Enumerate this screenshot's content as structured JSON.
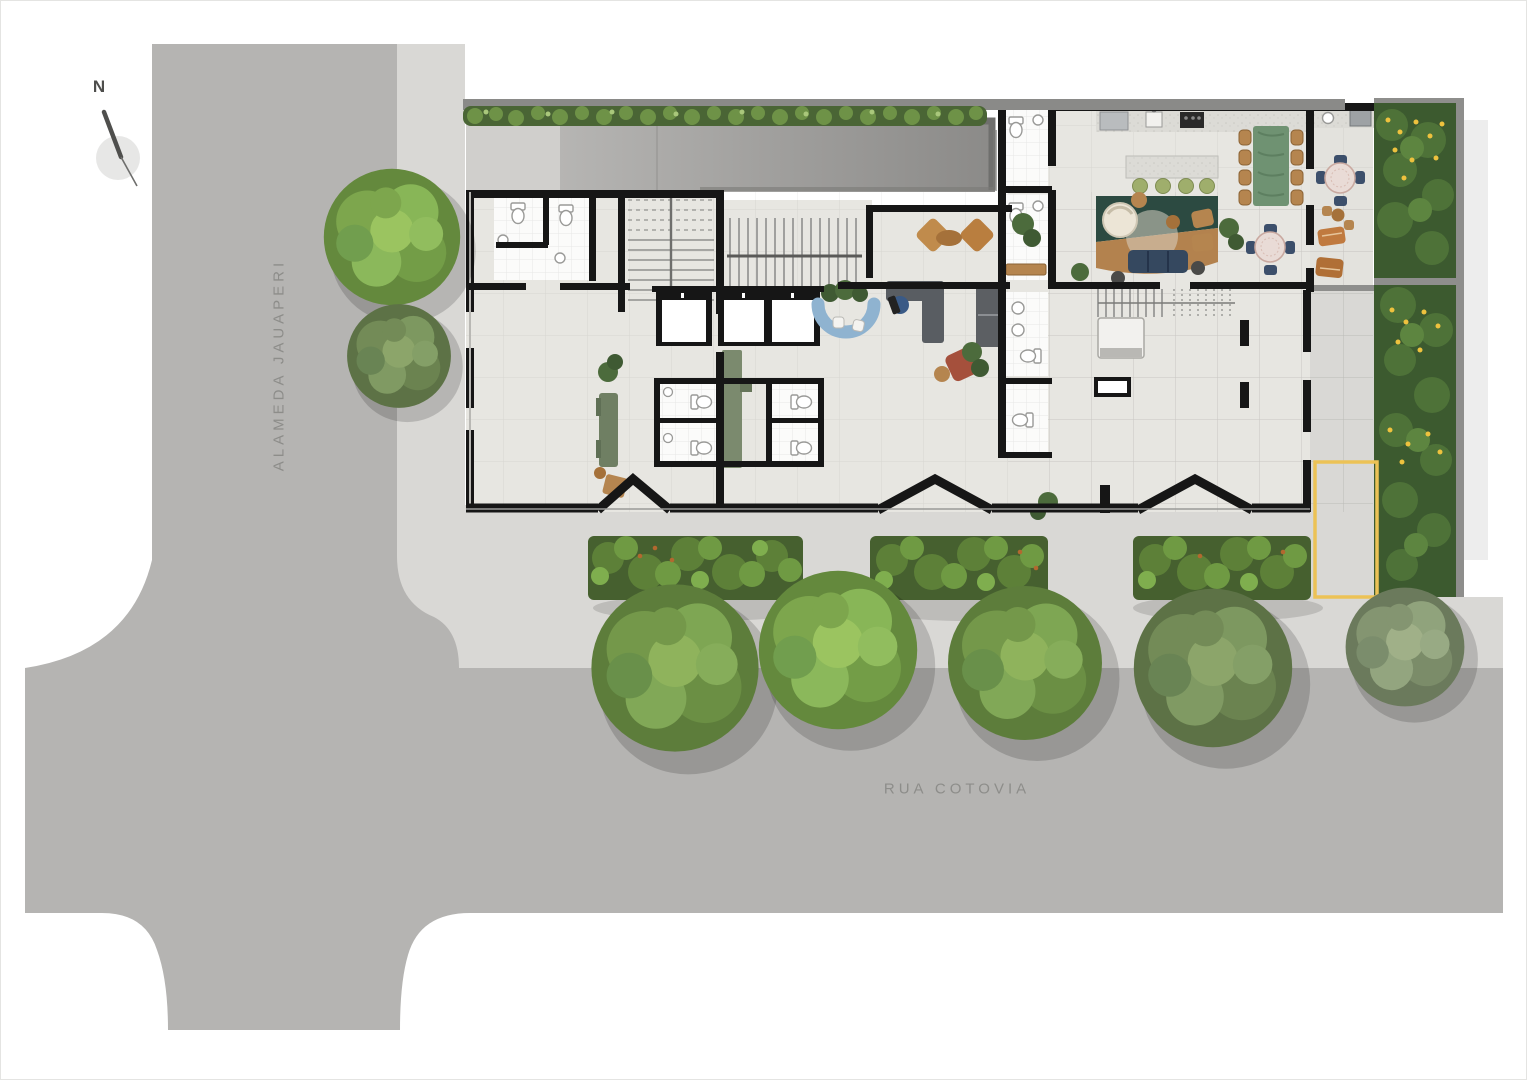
{
  "compass": {
    "label": "N"
  },
  "streets": [
    {
      "name": "ALAMEDA JAUAPERI",
      "orientation": "vertical"
    },
    {
      "name": "RUA COTOVIA",
      "orientation": "horizontal"
    }
  ],
  "palette": {
    "street": "#b5b4b2",
    "sidewalk": "#d9d8d5",
    "building_floor": "#e7e6e1",
    "bathroom_tile": "#fbfbfa",
    "wall": "#161616",
    "ramp_dark": "#8b8a88",
    "ramp_light": "#b2b1af",
    "hedge_green": "#55703c",
    "garden_base": "#3c5a2f",
    "flower_yellow": "#eec23e",
    "tree_green": "#6f9446",
    "reception_desk_blue": "#8fb3d0",
    "sofa_navy": "#35485f",
    "dining_table_green": "#6f9272",
    "wood_tan": "#b5854f",
    "rust_armchair": "#a5503c",
    "rug_green": "#2c4a41",
    "rug_tan": "#b3824e",
    "marked_bay_yellow": "#ecc256",
    "lockers_gray": "#5c5f63"
  },
  "features": {
    "elevators": 3,
    "terrace_round_tables": 2,
    "dining_chairs": 8,
    "street_trees_south": 5,
    "trees_west": 2,
    "hedge_beds_south": 3,
    "chevron_entrances": 3
  }
}
